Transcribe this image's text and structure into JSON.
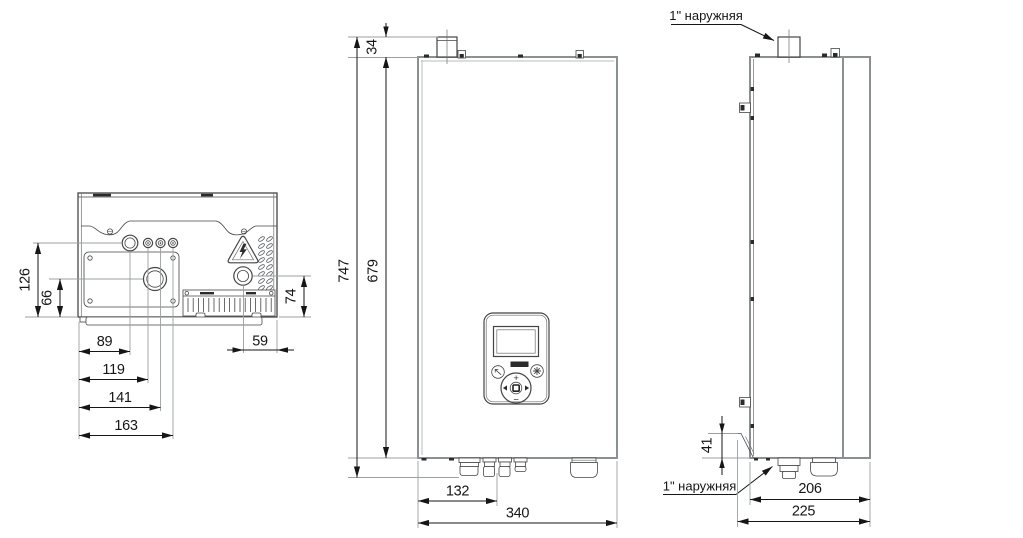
{
  "drawing": {
    "dims": {
      "d126": "126",
      "d66": "66",
      "d89": "89",
      "d119": "119",
      "d141": "141",
      "d163": "163",
      "d74": "74",
      "d59": "59",
      "d34": "34",
      "d747": "747",
      "d679": "679",
      "d132": "132",
      "d340": "340",
      "d41": "41",
      "d206": "206",
      "d225": "225"
    },
    "labels": {
      "thread_top": "1\" наружняя",
      "thread_bottom": "1\" наружняя"
    },
    "panel": {
      "plus": "+",
      "minus": "−"
    },
    "colors": {
      "background": "#ffffff",
      "body_edge": "#8b9092",
      "detail_line": "#454545",
      "dimension": "#161616",
      "extension": "#9aa0a2"
    }
  }
}
